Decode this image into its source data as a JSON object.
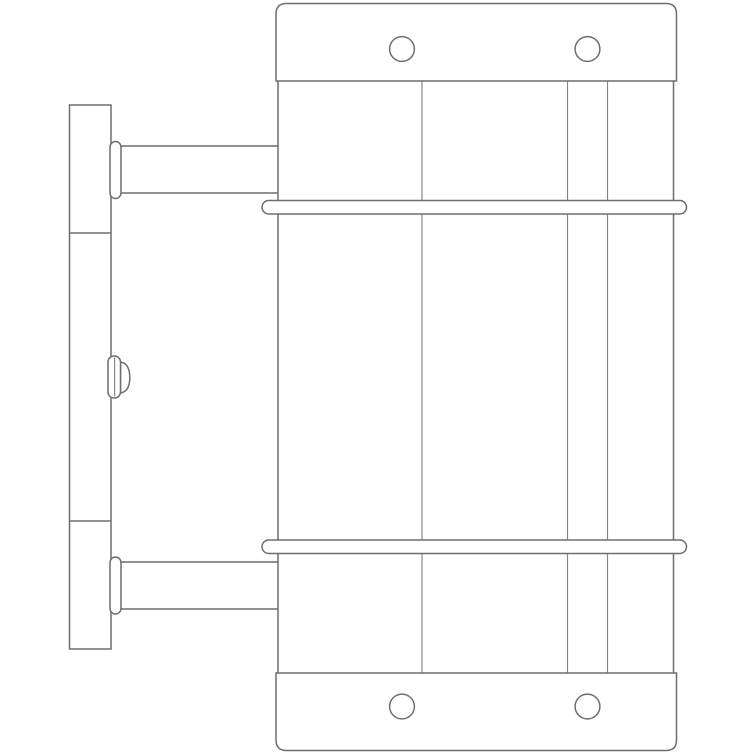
{
  "page": {
    "background_color": "#ffffff"
  },
  "drawing": {
    "type": "technical-line-drawing",
    "subject": "Side elevation line drawing of a wall-mounted cylindrical fixture",
    "stroke_color": "#6e6e6e",
    "stroke_color_light": "#858585",
    "background_color": "#ffffff",
    "components": {
      "wall_plate": {
        "section_lines": 2
      },
      "set_screw": {
        "count": 1
      },
      "mounting_arms": {
        "count": 2
      },
      "cylinder_body": {
        "inner_seam_lines": 3
      },
      "end_caps": {
        "count": 2,
        "screw_holes_per_cap": 2
      },
      "retaining_bands": {
        "count": 2
      }
    }
  }
}
